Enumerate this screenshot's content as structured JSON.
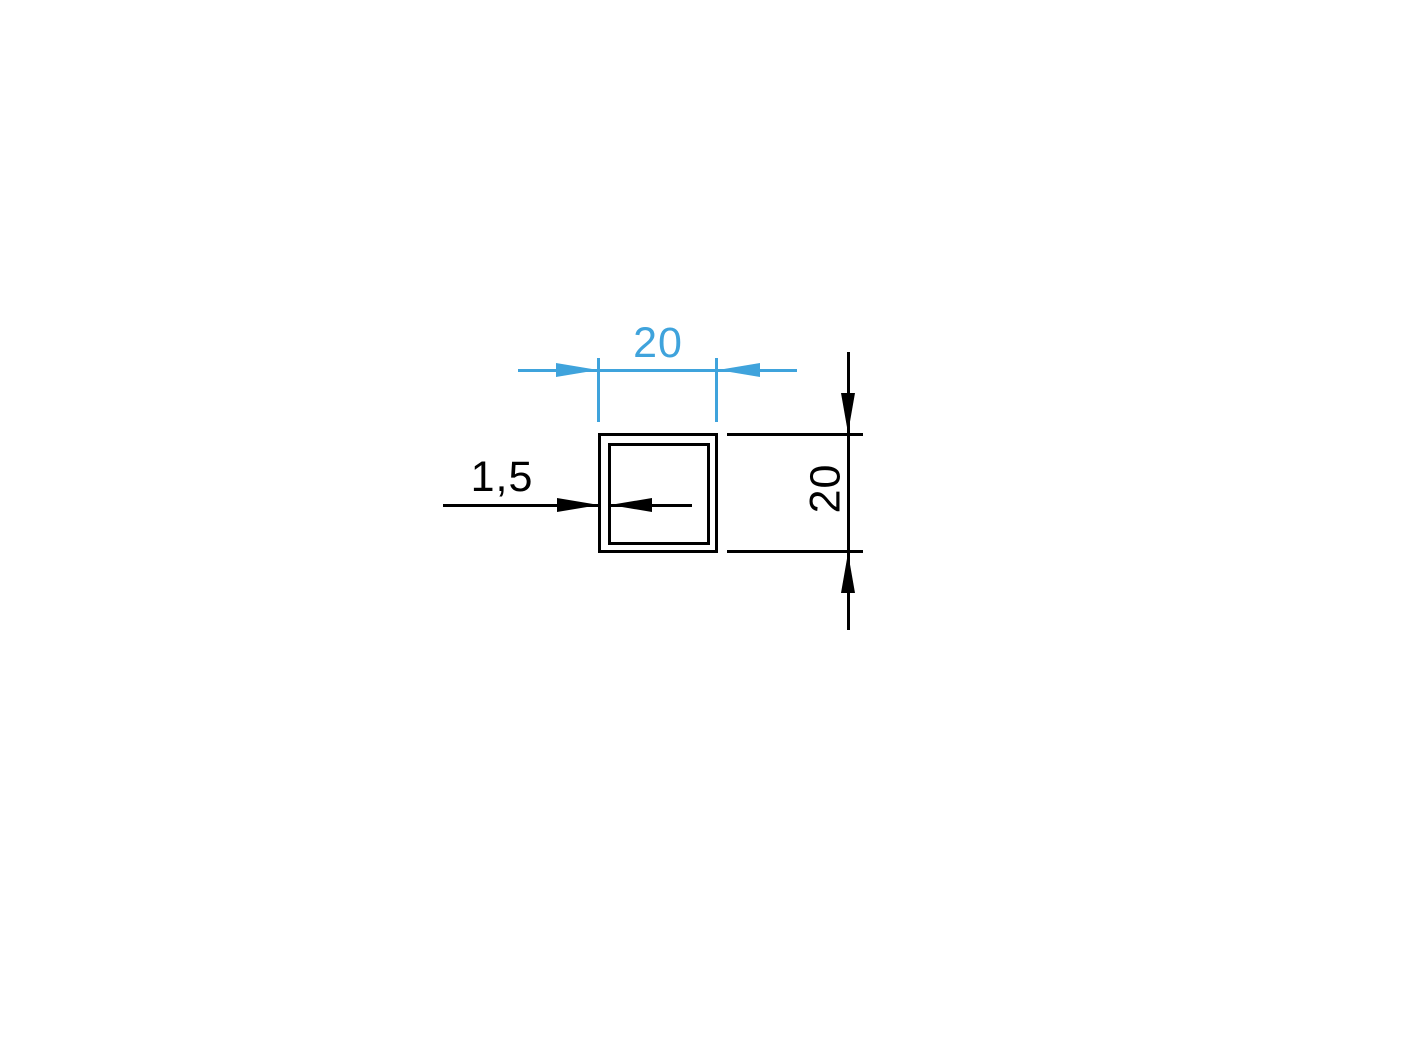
{
  "colors": {
    "dimension_blue": "#3FA3DC",
    "line_black": "#000000",
    "background": "#FFFFFF"
  },
  "drawing": {
    "type": "square-tube-profile-cross-section",
    "dimensions": {
      "width": {
        "label": "20",
        "color": "blue",
        "orientation": "horizontal-top"
      },
      "height": {
        "label": "20",
        "color": "black",
        "orientation": "vertical-right-rotated"
      },
      "wall_thickness": {
        "label": "1,5",
        "color": "black",
        "orientation": "horizontal-left"
      }
    }
  }
}
